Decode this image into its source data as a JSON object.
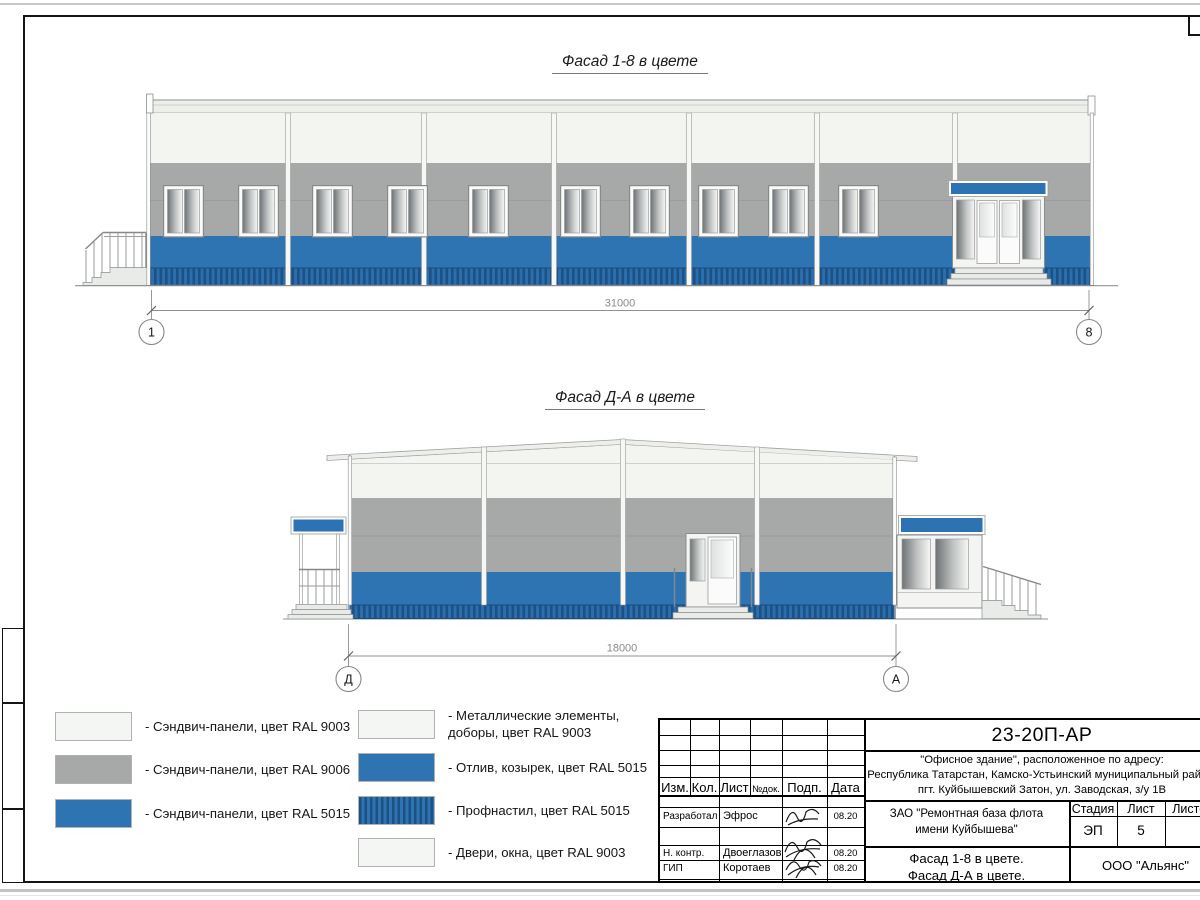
{
  "facades": {
    "top": {
      "title": "Фасад 1-8 в цвете",
      "dim": "31000",
      "axis_left": "1",
      "axis_right": "8"
    },
    "bottom": {
      "title": "Фасад Д-А в цвете",
      "dim": "18000",
      "axis_left": "Д",
      "axis_right": "А"
    }
  },
  "legend": {
    "left": [
      {
        "label": "- Сэндвич-панели, цвет RAL 9003",
        "swatch": "ral9003"
      },
      {
        "label": "- Сэндвич-панели, цвет RAL 9006",
        "swatch": "ral9006"
      },
      {
        "label": "- Сэндвич-панели, цвет RAL 5015",
        "swatch": "ral5015"
      }
    ],
    "right": [
      {
        "label": "- Металлические элементы, доборы, цвет RAL 9003",
        "swatch": "ral9003"
      },
      {
        "label": "- Отлив, козырек, цвет RAL 5015",
        "swatch": "ral5015"
      },
      {
        "label": "- Профнастил, цвет RAL 5015",
        "swatch": "ral5015-profiled"
      },
      {
        "label": "- Двери, окна, цвет RAL 9003",
        "swatch": "ral9003"
      }
    ]
  },
  "colors": {
    "ral9003": "#f3f6f2",
    "ral9006": "#a6a9a8",
    "ral5015": "#2e74b2"
  },
  "titleblock": {
    "doc_number": "23-20П-АР",
    "address_line1": "\"Офисное здание\", расположенное по адресу:",
    "address_line2": "Республика Татарстан, Камско-Устьинский муниципальный район,",
    "address_line3": "пгт. Куйбышевский Затон, ул. Заводская, з/у 1В",
    "client_line1": "ЗАО \"Ремонтная база флота",
    "client_line2": "имени Куйбышева\"",
    "sheet_name_line1": "Фасад 1-8 в цвете.",
    "sheet_name_line2": "Фасад Д-А в цвете.",
    "company": "ООО \"Альянс\"",
    "stage_label": "Стадия",
    "sheet_label": "Лист",
    "sheets_label": "Листов",
    "stage_value": "ЭП",
    "sheet_value": "5",
    "columns": [
      "Изм.",
      "Кол.",
      "Лист",
      "№док.",
      "Подп.",
      "Дата"
    ],
    "signature_rows": [
      {
        "role": "Разработал",
        "name": "Эфрос",
        "date": "08.20"
      },
      {
        "role": "Н. контр.",
        "name": "Двоеглазов",
        "date": "08.20"
      },
      {
        "role": "ГИП",
        "name": "Коротаев",
        "date": "08.20"
      }
    ]
  }
}
